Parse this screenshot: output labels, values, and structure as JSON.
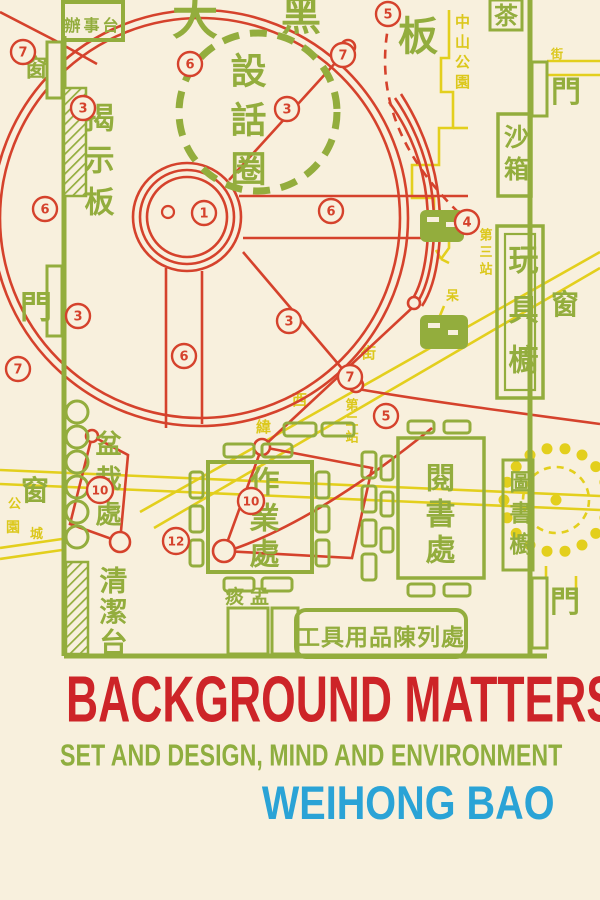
{
  "cover": {
    "title": "BACKGROUND MATTERS",
    "subtitle": "SET AND DESIGN, MIND AND ENVIRONMENT",
    "author": "WEIHONG BAO",
    "colors": {
      "background": "#f8f0dd",
      "diagram_red": "#d5422c",
      "diagram_green": "#93ad3d",
      "diagram_yellow": "#e3cf1d",
      "title_red": "#cd2428",
      "subtitle_green": "#8fae3f",
      "author_blue": "#2aa3d6"
    }
  },
  "plan": {
    "labels": {
      "big_blackboard_1": "大",
      "big_blackboard_2": "黑",
      "big_blackboard_3": "板",
      "office_desk": "辦事台",
      "notice_board": "揭示板",
      "talking_circle": "設話圈",
      "door": "門",
      "window": "窗",
      "tea": "茶",
      "sandbox": "沙箱",
      "toy_cabinet": "玩具櫥",
      "book_cabinet": "圖書櫥",
      "reading_area": "閱書處",
      "work_area": "作業處",
      "potted_plants": "盆栽處",
      "cleaning_table": "清潔台",
      "spittoon": "痰盂",
      "tool_display": "工具用品陳列處",
      "zhongshan_park": "中山公園",
      "station_2": "第二站",
      "station_3": "第三站",
      "street": "街",
      "street_west": "西",
      "street_wei": "緯",
      "park_wall_1": "公",
      "park_wall_2": "園",
      "park_wall_3": "城",
      "tree_mark": "呆"
    },
    "markers": [
      {
        "n": "1",
        "x": 204,
        "y": 213
      },
      {
        "n": "3",
        "x": 287,
        "y": 109
      },
      {
        "n": "3",
        "x": 83,
        "y": 108
      },
      {
        "n": "3",
        "x": 78,
        "y": 316
      },
      {
        "n": "3",
        "x": 289,
        "y": 321
      },
      {
        "n": "4",
        "x": 467,
        "y": 222
      },
      {
        "n": "5",
        "x": 388,
        "y": 14
      },
      {
        "n": "5",
        "x": 386,
        "y": 416
      },
      {
        "n": "6",
        "x": 190,
        "y": 64
      },
      {
        "n": "6",
        "x": 45,
        "y": 209
      },
      {
        "n": "6",
        "x": 331,
        "y": 211
      },
      {
        "n": "6",
        "x": 184,
        "y": 356
      },
      {
        "n": "7",
        "x": 23,
        "y": 52
      },
      {
        "n": "7",
        "x": 343,
        "y": 55
      },
      {
        "n": "7",
        "x": 18,
        "y": 369
      },
      {
        "n": "7",
        "x": 350,
        "y": 377
      },
      {
        "n": "10",
        "x": 100,
        "y": 490
      },
      {
        "n": "10",
        "x": 251,
        "y": 501
      },
      {
        "n": "12",
        "x": 176,
        "y": 541
      }
    ]
  }
}
